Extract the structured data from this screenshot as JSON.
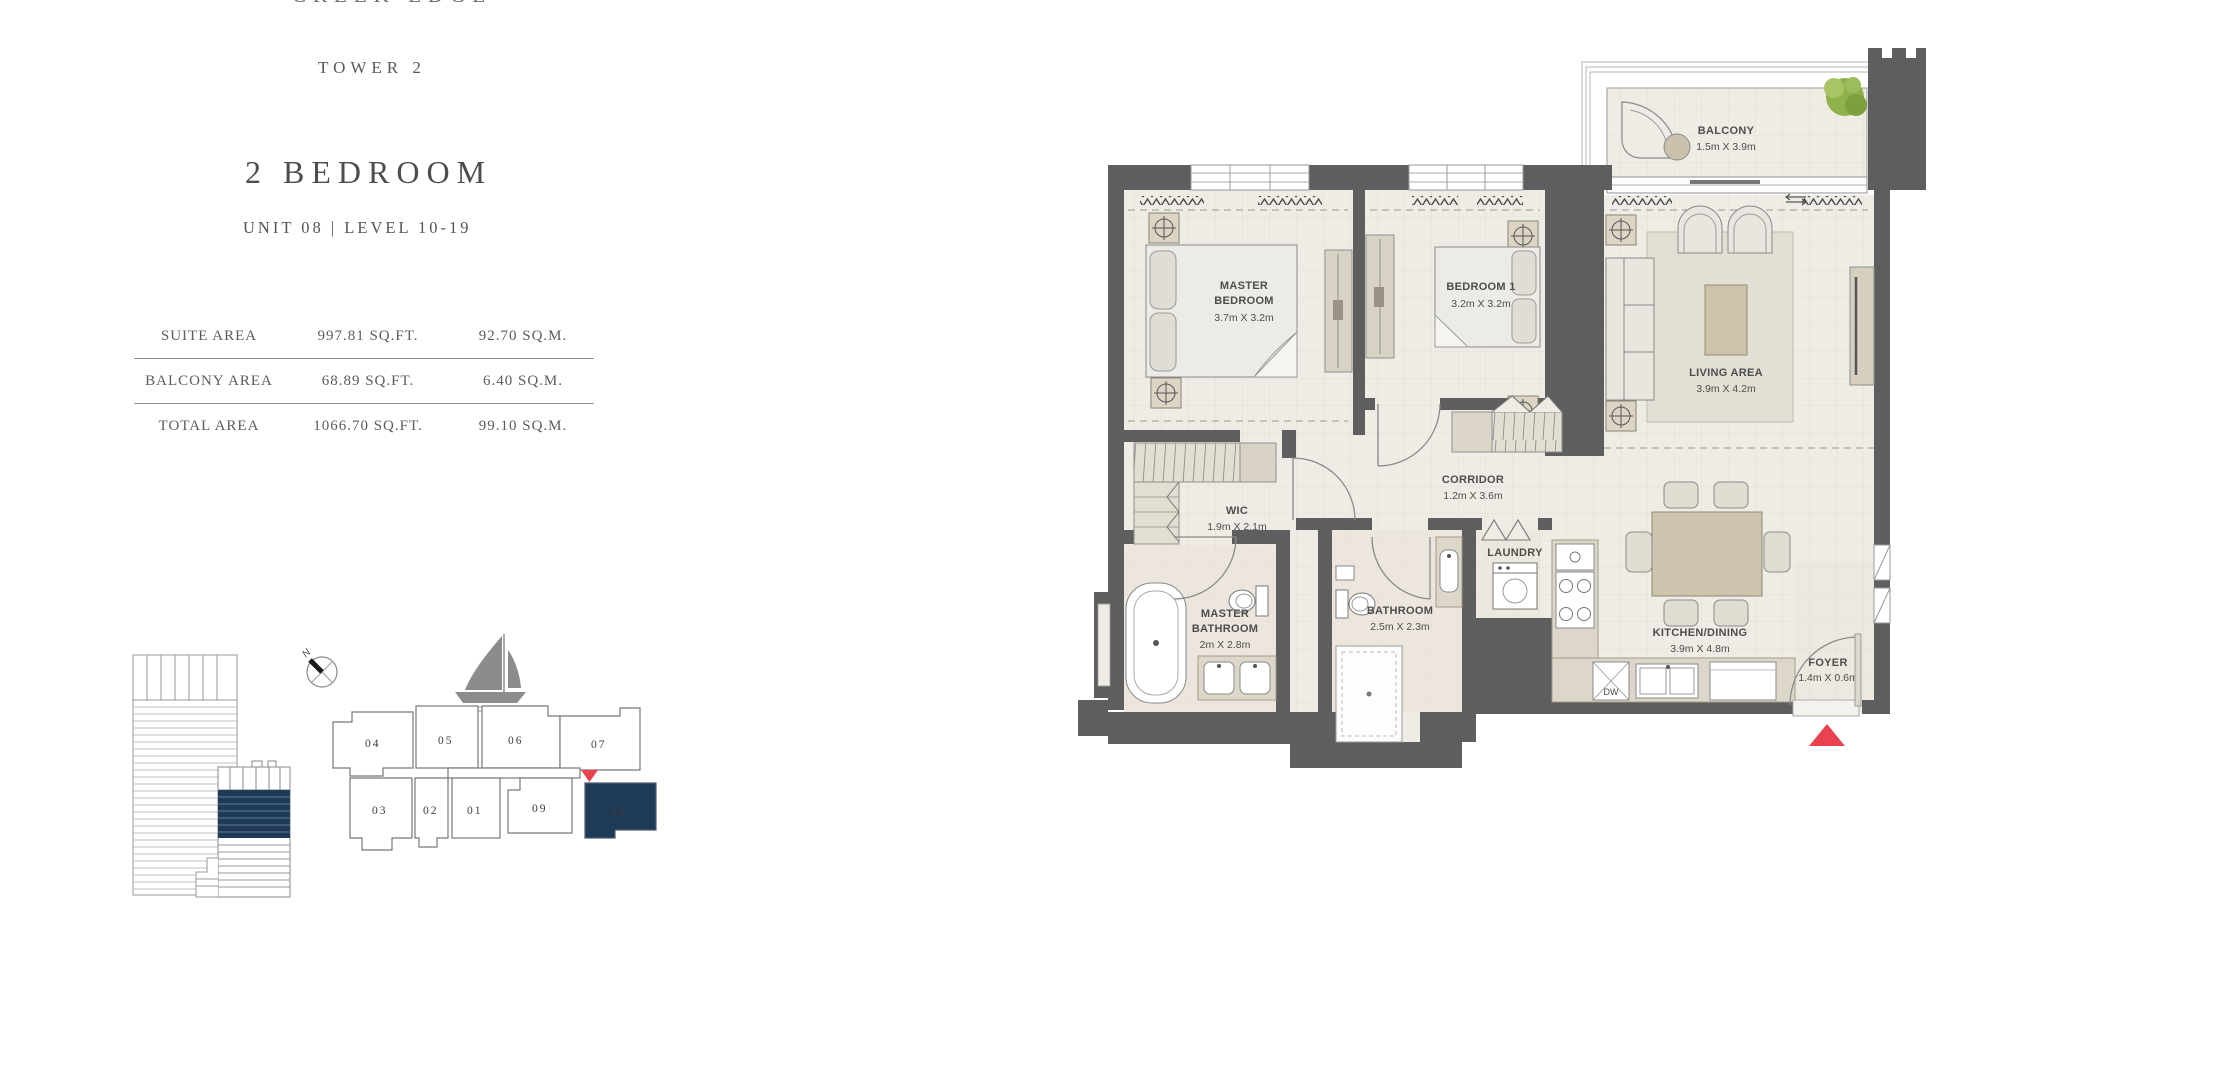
{
  "header": {
    "project_name": "CREEK EDGE",
    "tower": "TOWER 2",
    "unit_type": "2 BEDROOM",
    "unit_details": "UNIT 08 | LEVEL 10-19"
  },
  "area_table": {
    "rows": [
      {
        "label": "SUITE AREA",
        "imperial": "997.81 SQ.FT.",
        "metric": "92.70 SQ.M."
      },
      {
        "label": "BALCONY AREA",
        "imperial": "68.89 SQ.FT.",
        "metric": "6.40 SQ.M."
      },
      {
        "label": "TOTAL AREA",
        "imperial": "1066.70 SQ.FT.",
        "metric": "99.10 SQ.M."
      }
    ]
  },
  "floor_plan": {
    "master_bedroom": {
      "name_line1": "MASTER",
      "name_line2": "BEDROOM",
      "dims": "3.7m X 3.2m"
    },
    "bedroom_1": {
      "name": "BEDROOM 1",
      "dims": "3.2m X 3.2m"
    },
    "living_area": {
      "name": "LIVING AREA",
      "dims": "3.9m X 4.2m"
    },
    "balcony": {
      "name": "BALCONY",
      "dims": "1.5m X 3.9m"
    },
    "corridor": {
      "name": "CORRIDOR",
      "dims": "1.2m X 3.6m"
    },
    "wic": {
      "name": "WIC",
      "dims": "1.9m X 2.1m"
    },
    "master_bathroom": {
      "name_line1": "MASTER",
      "name_line2": "BATHROOM",
      "dims": "2m X 2.8m"
    },
    "bathroom": {
      "name": "BATHROOM",
      "dims": "2.5m X 2.3m"
    },
    "laundry": {
      "name": "LAUNDRY"
    },
    "kitchen_dining": {
      "name": "KITCHEN/DINING",
      "dims": "3.9m X 4.8m"
    },
    "foyer": {
      "name": "FOYER",
      "dims": "1.4m X 0.6m"
    },
    "dishwasher": "DW"
  },
  "key_plan": {
    "compass": "N",
    "units_top": [
      "04",
      "05",
      "06",
      "07"
    ],
    "units_bottom": [
      "03",
      "02",
      "01",
      "09"
    ],
    "highlighted_unit": "08"
  },
  "colors": {
    "accent_navy": "#1f3a56",
    "marker_red": "#e8434e",
    "wall_gray": "#5e5e5e",
    "floor_beige": "#efece6"
  }
}
